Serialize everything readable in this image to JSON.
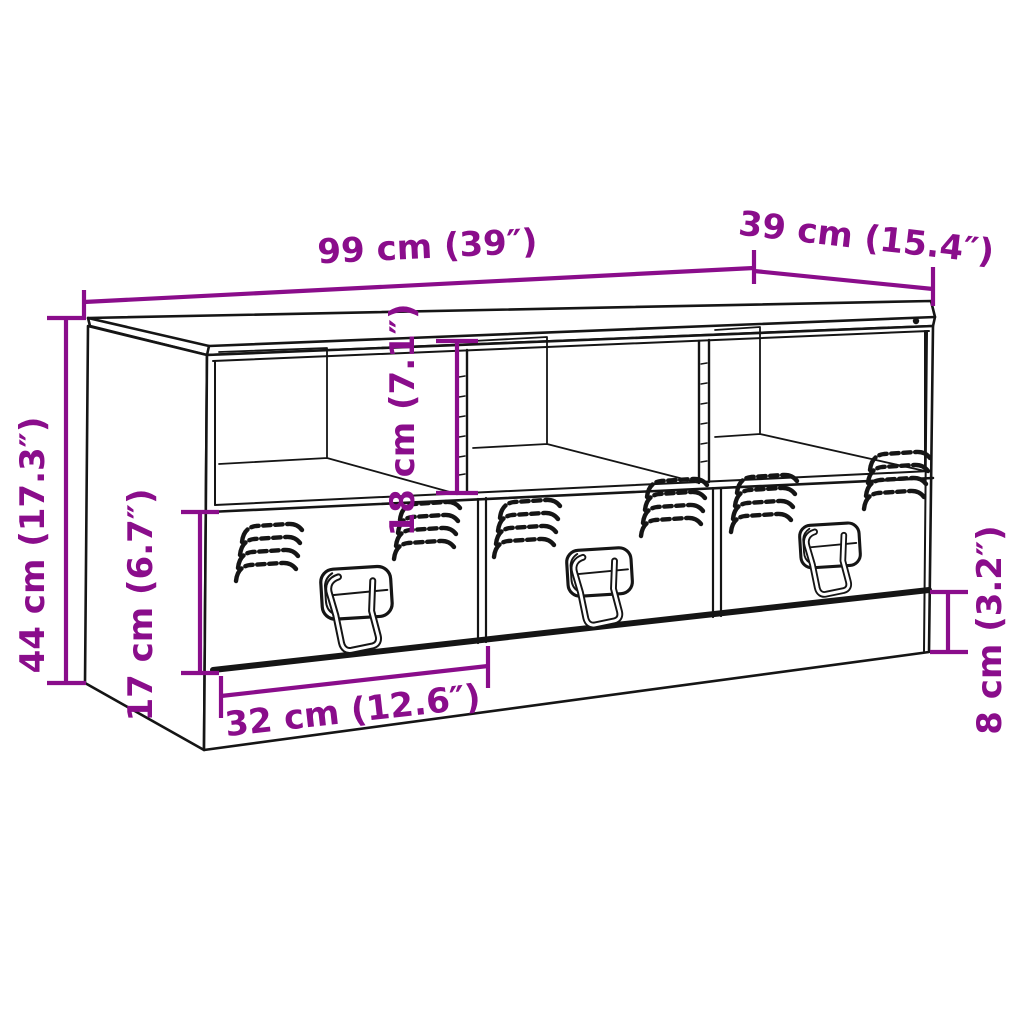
{
  "diagram": {
    "type": "furniture-dimension-diagram",
    "product": "TV stand with 3 open compartments and 3 drawers",
    "colors": {
      "dimension_accent": "#8A0D8B",
      "outline": "#151515",
      "background": "#FFFFFF"
    },
    "dimensions": {
      "width": {
        "label": "99 cm (39″)"
      },
      "depth": {
        "label": "39 cm (15.4″)"
      },
      "height": {
        "label": "44 cm (17.3″)"
      },
      "drawer_front_height": {
        "label": "17 cm (6.7″)"
      },
      "compartment_height": {
        "label": "18 cm (7.1″)"
      },
      "drawer_width": {
        "label": "32 cm (12.6″)"
      },
      "plinth_height": {
        "label": "8 cm (3.2″)"
      }
    }
  }
}
